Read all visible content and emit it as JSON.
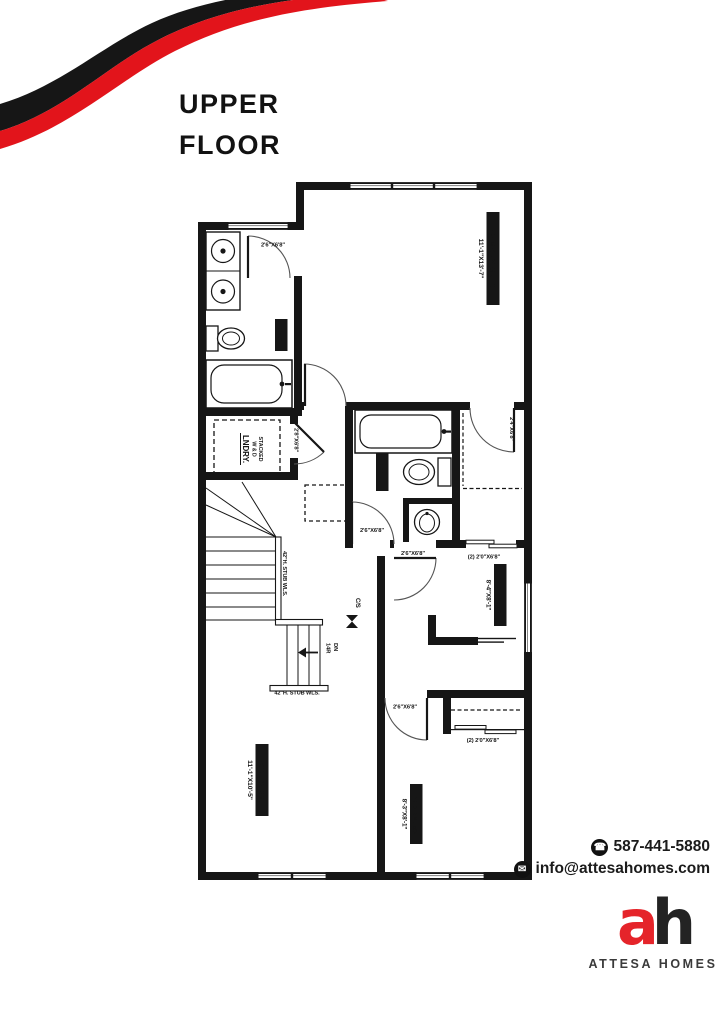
{
  "title": {
    "line1": "UPPER",
    "line2": "FLOOR"
  },
  "contact": {
    "phone": "587-441-5880",
    "email": "info@attesahomes.com"
  },
  "brand": {
    "monogram_a": "a",
    "monogram_h": "h",
    "name": "ATTESA HOMES"
  },
  "colors": {
    "swoosh_red": "#e2141b",
    "logo_red": "#e5242a",
    "wall_black": "#161616"
  },
  "fp": {
    "rooms": {
      "primary": {
        "name": "PRIMARY SUITE",
        "dims": "11'-1\"X13'-7\""
      },
      "ens": {
        "name": "ENS."
      },
      "laundry": {
        "l1": "STACKED",
        "l2": "W & D",
        "name": "LNDRY."
      },
      "bath": {
        "name": "BATH."
      },
      "bed2": {
        "name": "BEDRM. #2",
        "dims": "8'-4\"X8'-1\""
      },
      "bonus": {
        "name": "BONUS RM.",
        "dims": "11'-1\"X10'-5\""
      },
      "bed3": {
        "name": "BEDRM. #3",
        "dims": "8'-3\"X8'-1\""
      }
    },
    "doors": {
      "ens": "2'6\"X6'8\"",
      "primary": "2'6\"X6'8\"",
      "laundry": "2'8\"X6'8\"",
      "wic": "2'4\"X6'8\"",
      "bath": "2'6\"X6'8\"",
      "bed2": "2'6\"X6'8\"",
      "bed2_closet": "(2)  2'0\"X6'8\"",
      "bed3": "2'6\"X6'8\"",
      "bed3_closet": "(2)  2'0\"X6'8\""
    },
    "notes": {
      "stub_v": "42\"H. STUB WLS.",
      "stub_h": "42\"H. STUB WLS.",
      "dn": "DN",
      "risers": "14R",
      "cs": "C/S"
    }
  }
}
